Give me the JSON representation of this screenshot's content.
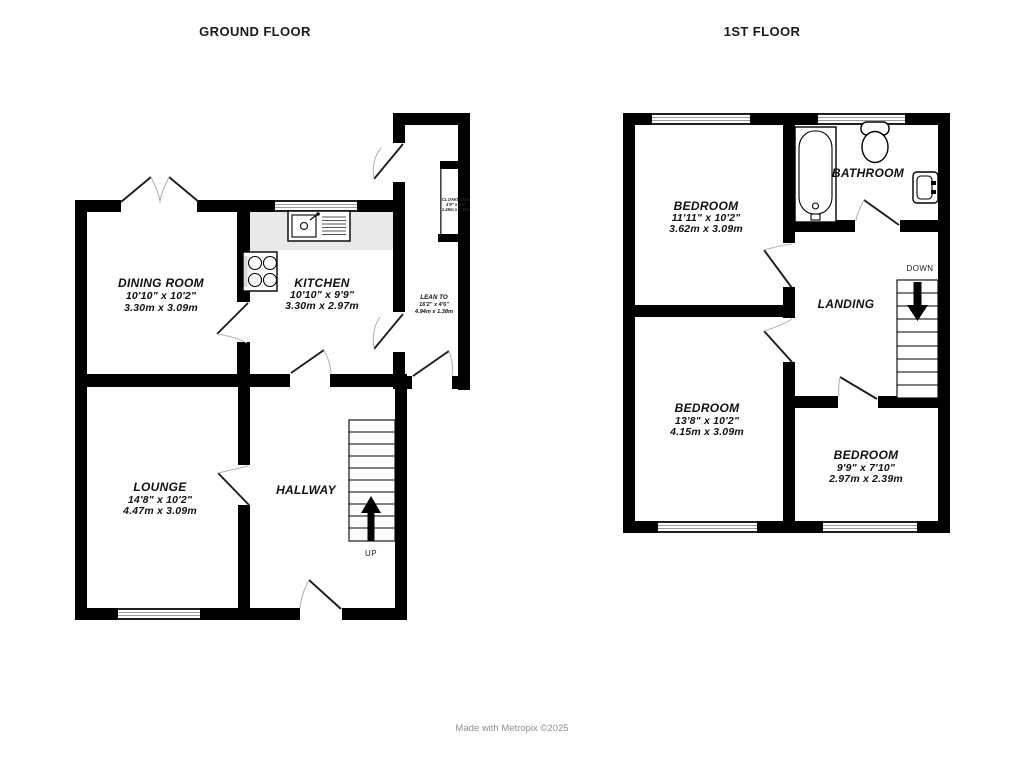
{
  "titles": {
    "ground_floor": "GROUND FLOOR",
    "first_floor": "1ST FLOOR"
  },
  "credit": "Made with Metropix ©2025",
  "ground_floor": {
    "dining_room": {
      "name": "DINING ROOM",
      "imperial": "10'10\"  x 10'2\"",
      "metric": "3.30m  x 3.09m"
    },
    "kitchen": {
      "name": "KITCHEN",
      "imperial": "10'10\"  x 9'9\"",
      "metric": "3.30m  x 2.97m"
    },
    "lean_to": {
      "name": "LEAN TO",
      "imperial": "16'2\"  x 4'6\"",
      "metric": "4.94m  x 1.38m"
    },
    "cloakroom": {
      "name": "CLOAKROOM",
      "imperial": "4'9\" x 4'6\"",
      "metric": "1.45m x 1.38m"
    },
    "lounge": {
      "name": "LOUNGE",
      "imperial": "14'8\"  x 10'2\"",
      "metric": "4.47m  x 3.09m"
    },
    "hallway": {
      "name": "HALLWAY"
    },
    "stairs": {
      "label": "UP"
    }
  },
  "first_floor": {
    "bedroom1": {
      "name": "BEDROOM",
      "imperial": "11'11\"  x 10'2\"",
      "metric": "3.62m  x 3.09m"
    },
    "bathroom": {
      "name": "BATHROOM"
    },
    "landing": {
      "name": "LANDING"
    },
    "bedroom2": {
      "name": "BEDROOM",
      "imperial": "13'8\"  x 10'2\"",
      "metric": "4.15m  x 3.09m"
    },
    "bedroom3": {
      "name": "BEDROOM",
      "imperial": "9'9\"  x 7'10\"",
      "metric": "2.97m  x 2.39m"
    },
    "stairs": {
      "label": "DOWN"
    }
  }
}
